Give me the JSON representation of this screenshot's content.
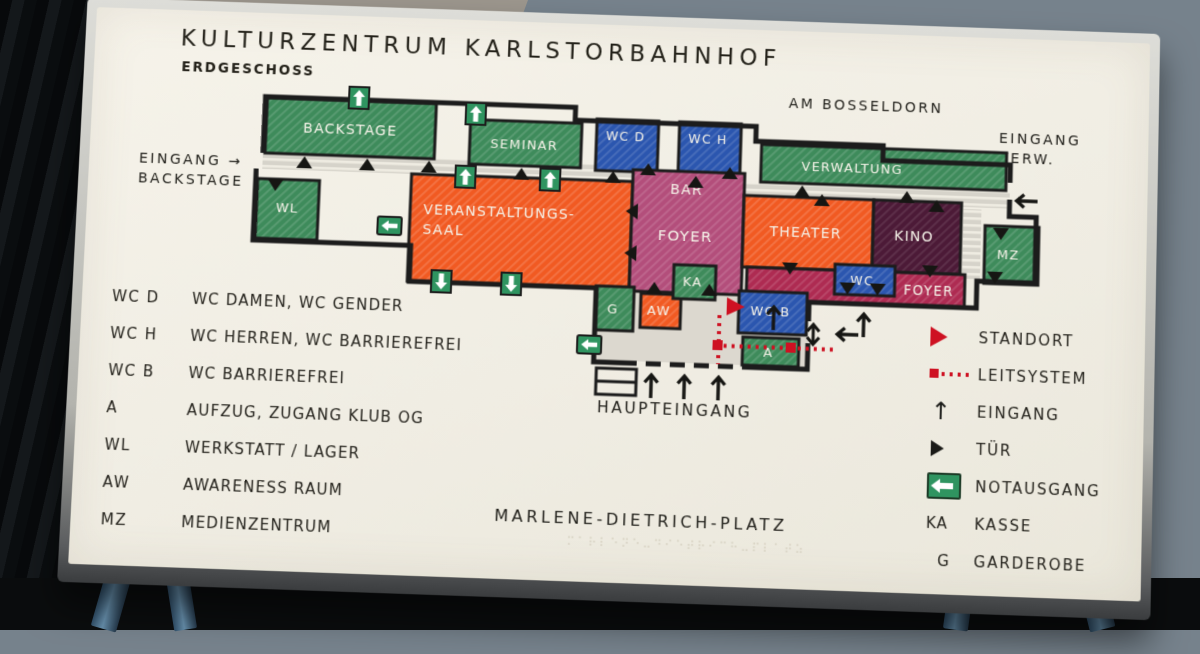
{
  "header": {
    "title": "KULTURZENTRUM KARLSTORBAHNHOF",
    "subtitle": "ERDGESCHOSS"
  },
  "streets": {
    "top": "AM BOSSELDORN",
    "bottom": "MARLENE-DIETRICH-PLATZ"
  },
  "entrances": {
    "verw_line1": "EINGANG",
    "verw_line2": "VERW.",
    "backstage_line1": "EINGANG →",
    "backstage_line2": "BACKSTAGE",
    "main": "HAUPTEINGANG"
  },
  "rooms": {
    "backstage": "BACKSTAGE",
    "seminar": "SEMINAR",
    "wc_d": "WC D",
    "wc_h": "WC H",
    "verwaltung": "VERWALTUNG",
    "wl": "WL",
    "saal_line1": "VERANSTALTUNGS-",
    "saal_line2": "SAAL",
    "bar": "BAR",
    "foyer": "FOYER",
    "theater": "THEATER",
    "kino": "KINO",
    "mz": "MZ",
    "wc": "WC",
    "foyer_south": "FOYER",
    "g": "G",
    "aw": "AW",
    "ka": "KA",
    "wc_b": "WC B",
    "a": "A"
  },
  "legend_left": {
    "rows": [
      {
        "code": "WC D",
        "desc": "WC DAMEN, WC GENDER"
      },
      {
        "code": "WC H",
        "desc": "WC HERREN, WC BARRIEREFREI"
      },
      {
        "code": "WC B",
        "desc": "WC BARRIEREFREI"
      },
      {
        "code": "A",
        "desc": "AUFZUG, ZUGANG KLUB OG"
      },
      {
        "code": "WL",
        "desc": "WERKSTATT / LAGER"
      },
      {
        "code": "AW",
        "desc": "AWARENESS RAUM"
      },
      {
        "code": "MZ",
        "desc": "MEDIENZENTRUM"
      }
    ]
  },
  "legend_right": {
    "rows": [
      {
        "icon": "standort-icon",
        "label": "STANDORT"
      },
      {
        "icon": "leitsystem-icon",
        "label": "LEITSYSTEM"
      },
      {
        "icon": "entrance-arrow-icon",
        "label": "EINGANG"
      },
      {
        "icon": "door-icon",
        "label": "TÜR"
      },
      {
        "icon": "emergency-exit-icon",
        "label": "NOTAUSGANG"
      },
      {
        "code": "KA",
        "label": "KASSE"
      },
      {
        "code": "G",
        "label": "GARDEROBE"
      }
    ]
  },
  "icons": {
    "up_arrow": "↑"
  },
  "braille_row": "⠍⠁⠗⠇⠑⠝⠑⠤⠙⠊⠑⠞⠗⠊⠉⠓⠤⠏⠇⠁⠞⠵",
  "colors": {
    "room_green": "#3e8b5b",
    "room_blue": "#2b56af",
    "room_orange": "#f15a22",
    "room_magenta": "#b34e7b",
    "room_crimson": "#ae2b52",
    "room_maroon": "#4c1a37",
    "signal_red": "#ce1122",
    "wall_black": "#1c1c1c",
    "panel_cream": "#f2efe6",
    "exit_green": "#2f9460"
  }
}
